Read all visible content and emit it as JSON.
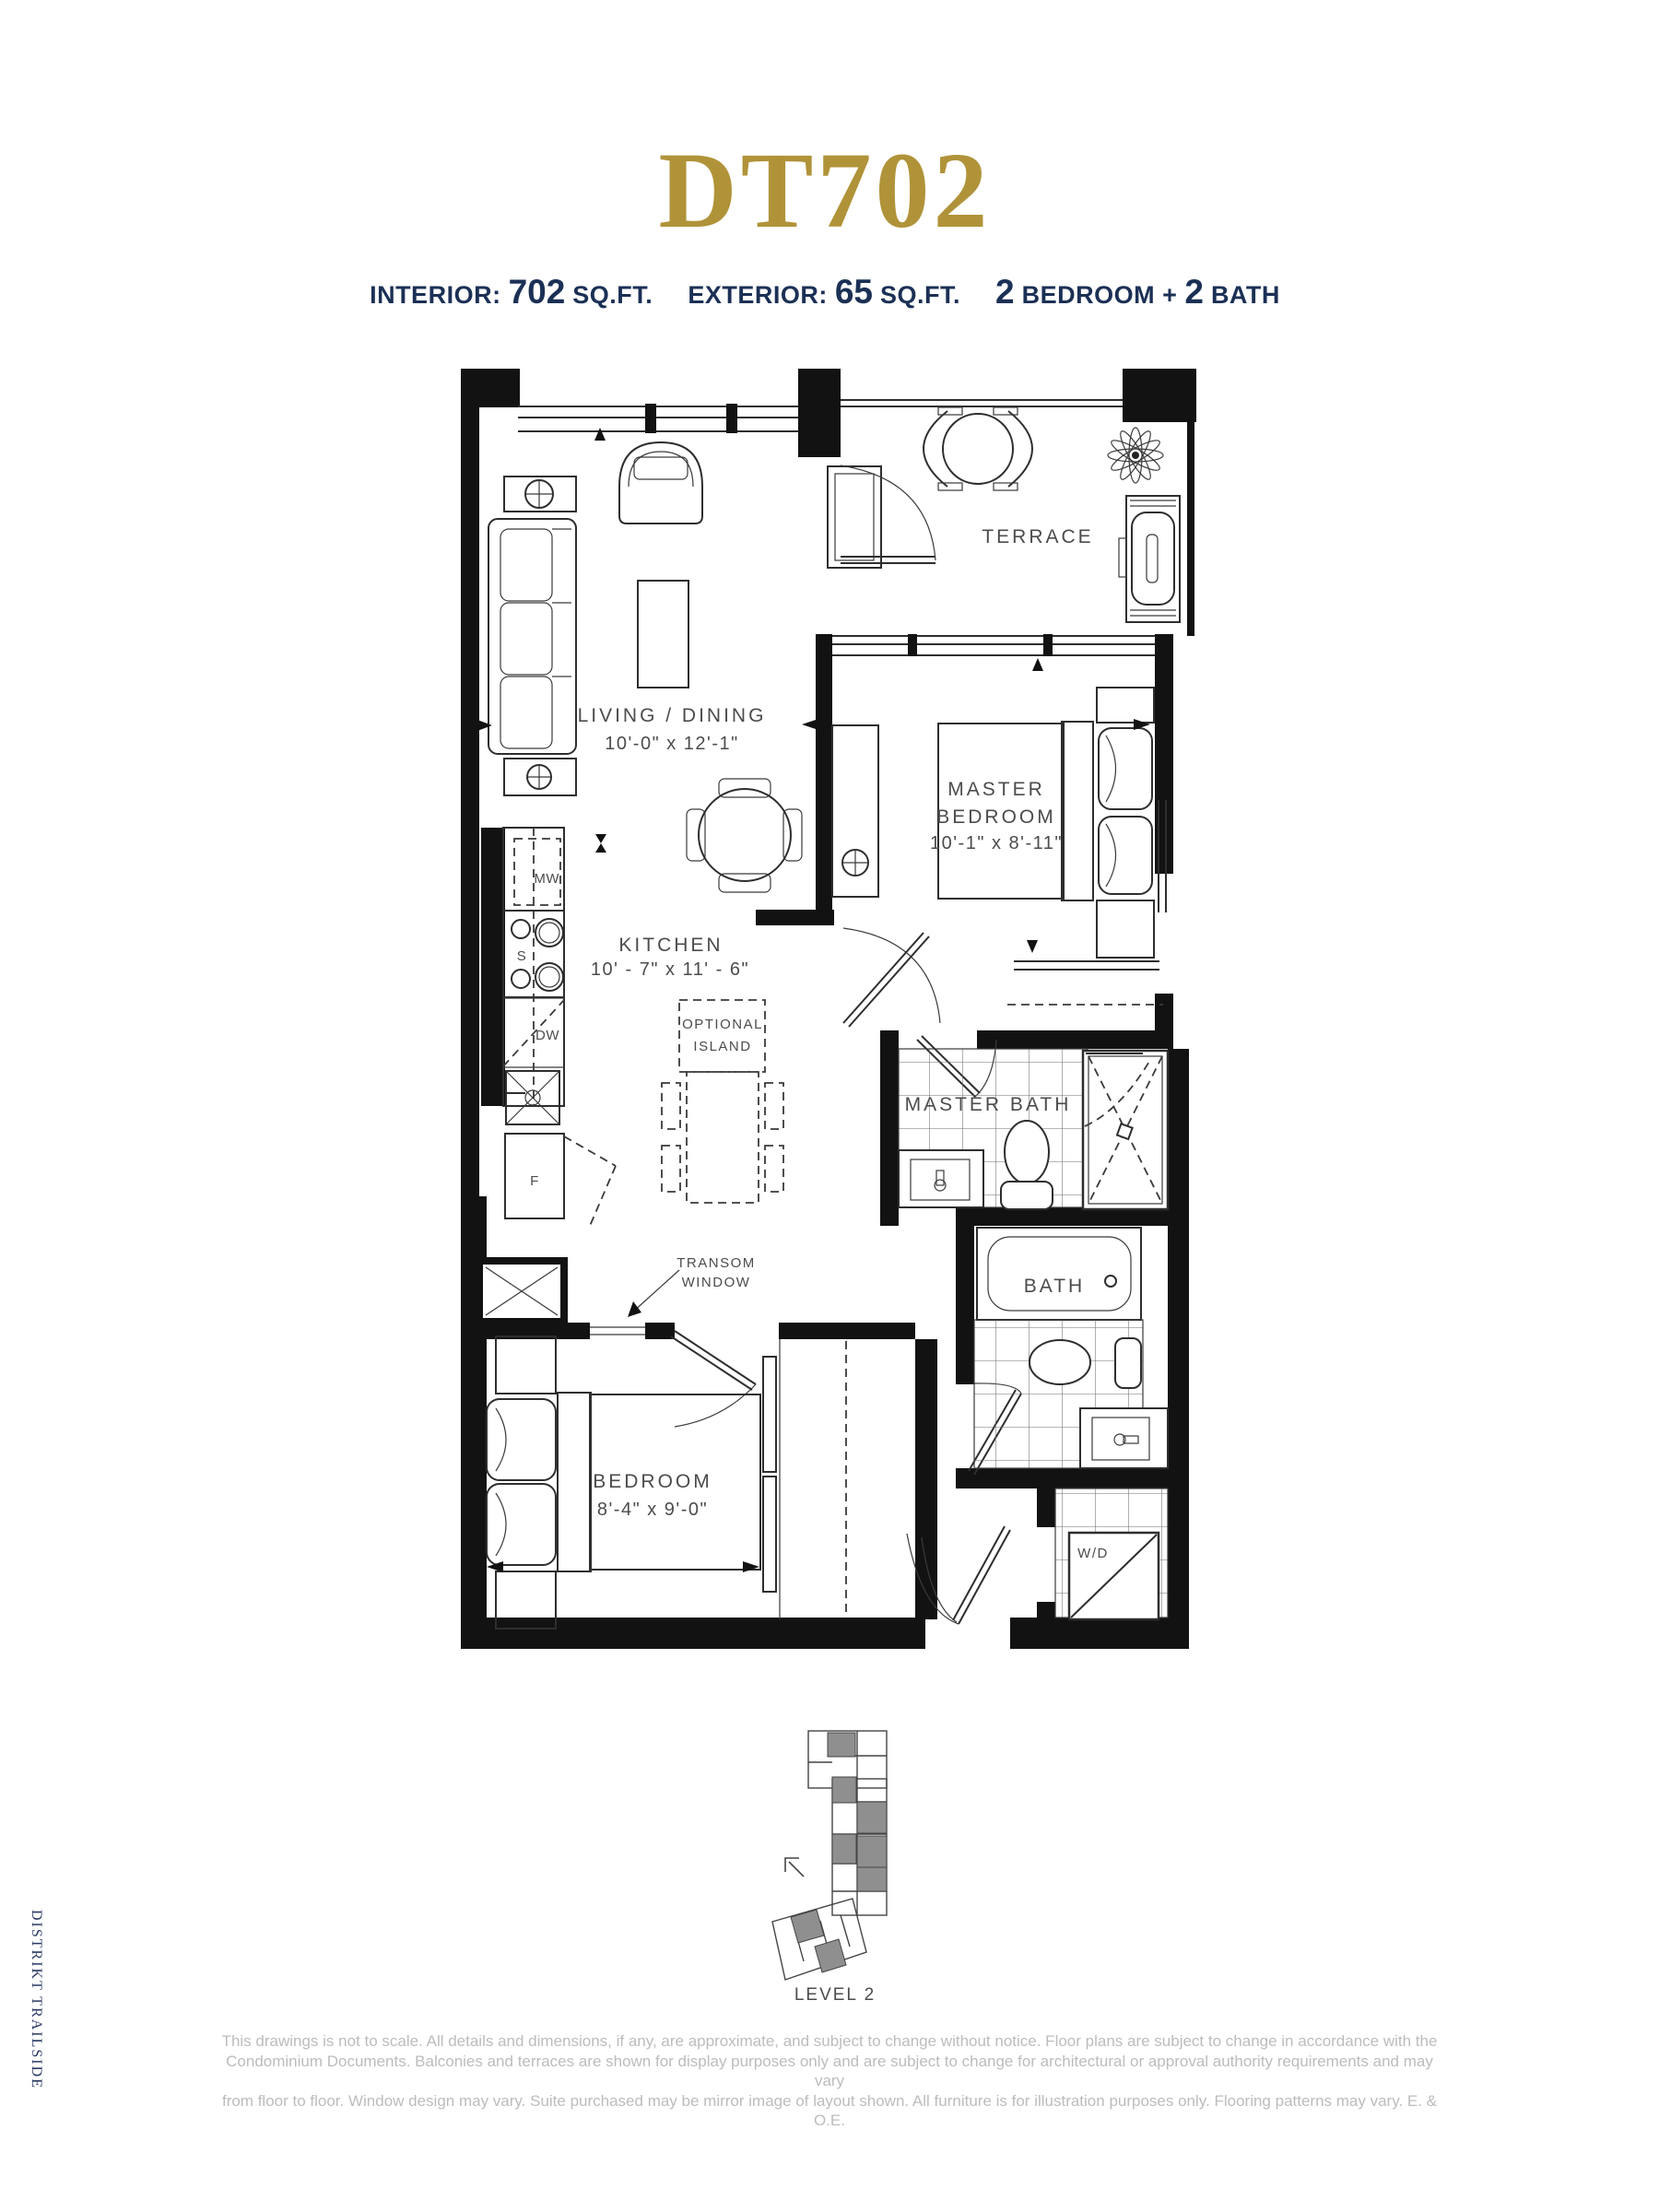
{
  "header": {
    "unit_code": "DT702",
    "interior_label": "INTERIOR:",
    "interior_value": "702",
    "interior_unit": "SQ.FT.",
    "exterior_label": "EXTERIOR:",
    "exterior_value": "65",
    "exterior_unit": "SQ.FT.",
    "config_num1": "2",
    "config_mid": "BEDROOM +",
    "config_num2": "2",
    "config_end": "BATH"
  },
  "side_text": "DISTRIKT TRAILSIDE",
  "floor_plan": {
    "rooms": {
      "terrace": {
        "label": "TERRACE"
      },
      "living_dining": {
        "label": "LIVING / DINING",
        "dimensions": "10'-0\" x 12'-1\""
      },
      "master_bedroom": {
        "label_line1": "MASTER",
        "label_line2": "BEDROOM",
        "dimensions": "10'-1\" x 8'-11\""
      },
      "kitchen": {
        "label": "KITCHEN",
        "dimensions": "10' - 7\" x 11' - 6\""
      },
      "optional_island": {
        "label_line1": "OPTIONAL",
        "label_line2": "ISLAND"
      },
      "master_bath": {
        "label": "MASTER BATH"
      },
      "bath": {
        "label": "BATH"
      },
      "bedroom": {
        "label": "BEDROOM",
        "dimensions": "8'-4\" x 9'-0\""
      },
      "laundry": {
        "label": "W/D"
      },
      "transom": {
        "label_line1": "TRANSOM",
        "label_line2": "WINDOW"
      }
    },
    "appliances": {
      "microwave": "MW",
      "stove": "S",
      "dishwasher": "DW",
      "fridge": "F"
    }
  },
  "keyplan": {
    "label": "LEVEL 2"
  },
  "disclaimer": {
    "line1": "This drawings is not to scale. All details and dimensions, if any, are approximate, and subject to change without notice. Floor plans are subject to change in accordance with the",
    "line2": "Condominium Documents. Balconies and terraces are shown for display purposes only and are subject to change for architectural or approval authority requirements and may vary",
    "line3": "from floor to floor. Window design may vary. Suite purchased may be mirror image of layout shown. All furniture is for illustration purposes only. Flooring patterns may vary. E. & O.E."
  },
  "colors": {
    "gold": "#b09339",
    "navy": "#1b3055",
    "plan_line": "#2e2e2e",
    "label_gray": "#4c4c4c",
    "disclaimer_gray": "#bcbcbc",
    "keyplan_gray": "#8f8f8f"
  }
}
